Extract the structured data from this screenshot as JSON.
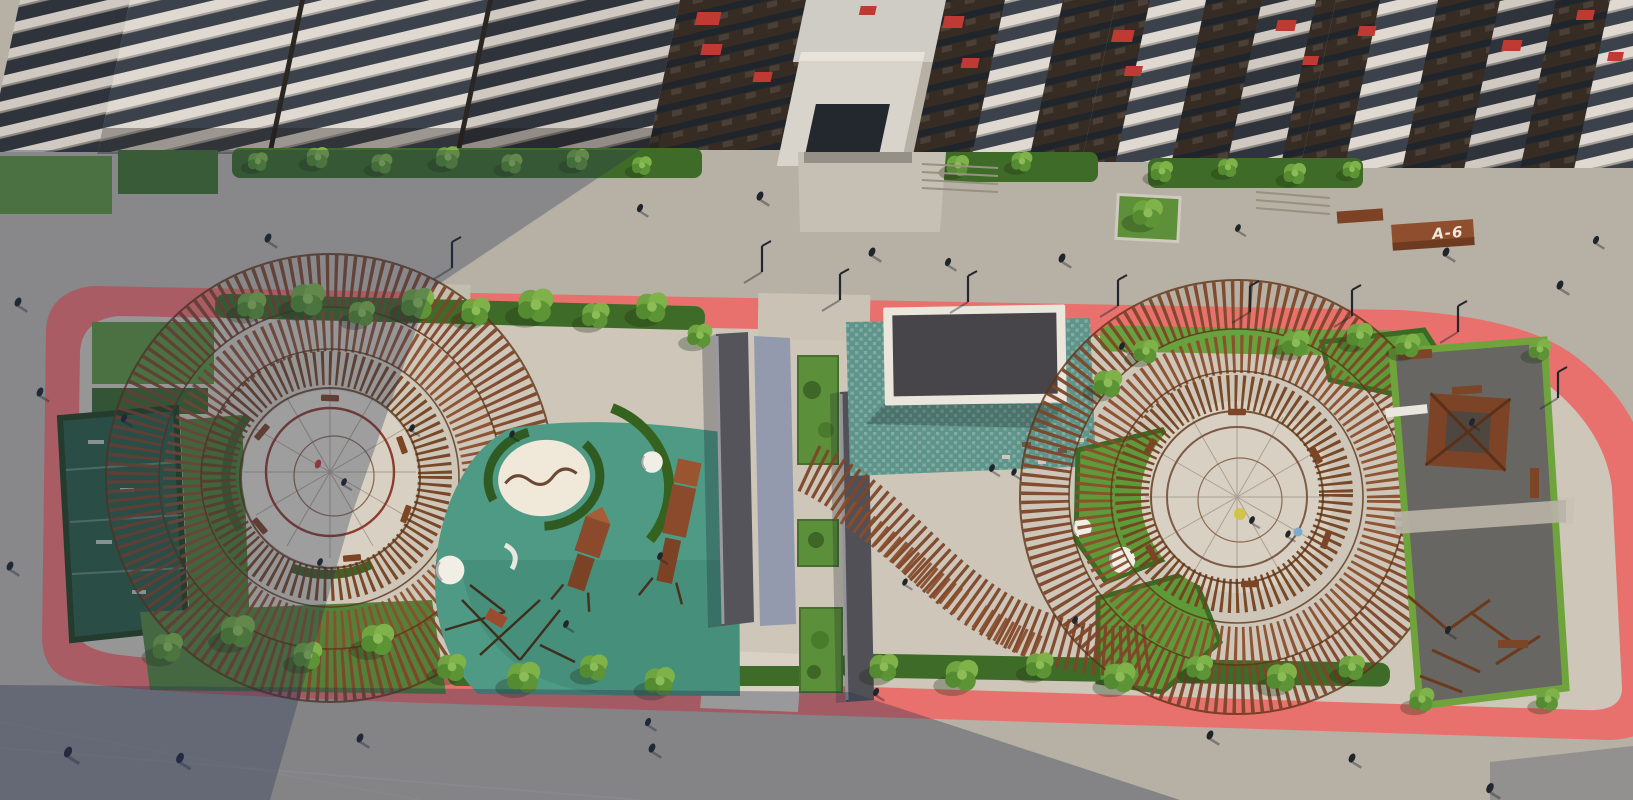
{
  "scene": {
    "title": "Aerial 3D rendering of a residential courtyard with two circular playground pergolas",
    "view": "top-down oblique architectural visualization",
    "labels": {
      "building_marker": "A-6"
    },
    "palette": {
      "pavement_lit": "#b7b0a4",
      "pavement_shadow": "#5f6678",
      "park_paving": "#cdc6b9",
      "pink_path": "#e8716d",
      "rubber_teal": "#4f9a84",
      "rubber_dark": "#686662",
      "plaza_teal": "#5e948a",
      "grass": "#67a03d",
      "hedge": "#3f6b28",
      "pergola_wood": "#7d4628",
      "facade_light": "#ded8d0",
      "facade_dark": "#352c26",
      "accent_red": "#bf3a33",
      "pavilion_roof": "#47454a"
    },
    "features": [
      "apartment buildings with balconies along the top",
      "entrance archway between buildings",
      "sidewalk with pedestrians and street lamps",
      "pink looped running path around courtyard",
      "left circular timber pergola with rope-web play circle",
      "teal rubber playground with sand pit and climbing towers",
      "central pavilion with dark flat roof on checkered plaza",
      "right circular timber pergola with rope-web play circle",
      "outdoor fitness area with wooden gazebo",
      "wayfinding bench marked A-6",
      "building shadows across pavement"
    ]
  }
}
